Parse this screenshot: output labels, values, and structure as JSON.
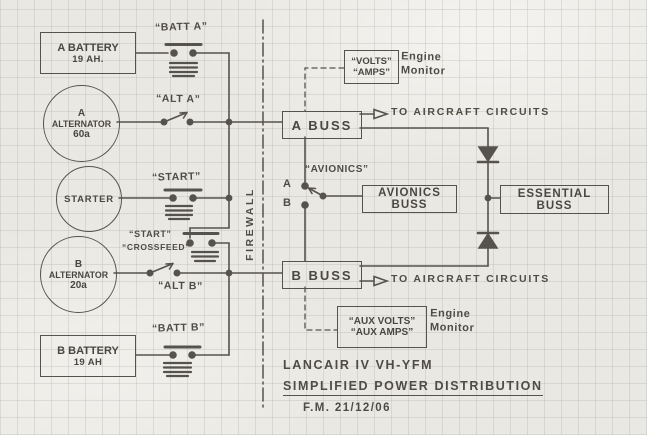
{
  "colors": {
    "paper": "#eae8e2",
    "pencil": "#4a4742"
  },
  "components": {
    "battery_a": {
      "line1": "A BATTERY",
      "line2": "19 AH."
    },
    "alternator_a": {
      "line1": "A",
      "line2": "ALTERNATOR",
      "line3": "60a"
    },
    "starter": {
      "label": "STARTER"
    },
    "alternator_b": {
      "line1": "B",
      "line2": "ALTERNATOR",
      "line3": "20a"
    },
    "battery_b": {
      "line1": "B BATTERY",
      "line2": "19 AH"
    }
  },
  "switch_labels": {
    "batt_a": "“BATT A”",
    "alt_a": "“ALT A”",
    "start": "“START”",
    "crossfeed_line1": "“START”",
    "crossfeed_line2": "“CROSSFEED”",
    "alt_b": "“ALT B”",
    "batt_b": "“BATT B”",
    "avionics": "“AVIONICS”",
    "avionics_pos_a": "A",
    "avionics_pos_b": "B"
  },
  "busses": {
    "a_buss": "A BUSS",
    "b_buss": "B BUSS",
    "avionics_buss": "AVIONICS BUSS",
    "essential_buss": "ESSENTIAL BUSS"
  },
  "monitors": {
    "volts": "“VOLTS”",
    "amps": "“AMPS”",
    "aux_volts": "“AUX VOLTS”",
    "aux_amps": "“AUX AMPS”",
    "engine_monitor_top": "Engine Monitor",
    "engine_monitor_bottom": "Engine Monitor"
  },
  "annotations": {
    "firewall": "FIREWALL",
    "to_circuits_top": "TO AIRCRAFT CIRCUITS",
    "to_circuits_bottom": "TO AIRCRAFT CIRCUITS"
  },
  "title_block": {
    "line1": "LANCAIR IV   VH-YFM",
    "line2": "SIMPLIFIED POWER DISTRIBUTION",
    "line3": "F.M.    21/12/06"
  }
}
